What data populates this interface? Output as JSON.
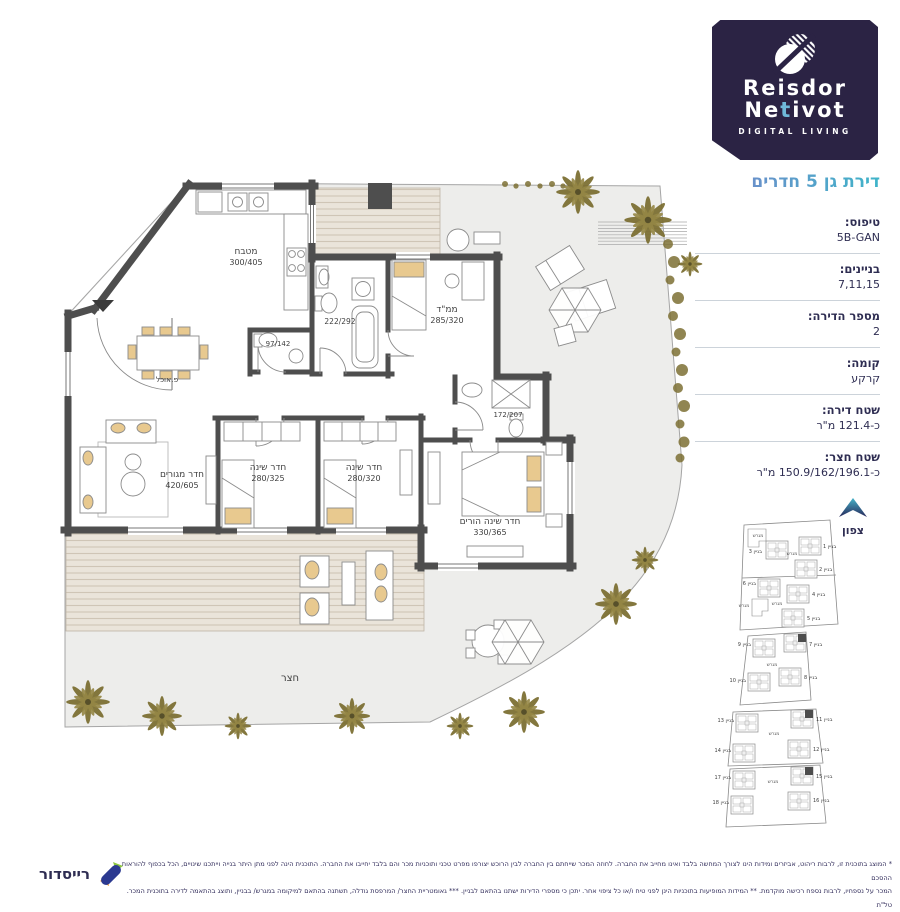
{
  "brand": {
    "name_line1": "Reisdor",
    "name_line2_pre": "Ne",
    "name_line2_accent": "t",
    "name_line2_post": "ivot",
    "tagline": "DIGITAL LIVING"
  },
  "header": {
    "title": "דירת גן 5 חדרים"
  },
  "details": {
    "rows": [
      {
        "label": "טיפוס:",
        "value": "5B-GAN"
      },
      {
        "label": "בניינים:",
        "value": "7,11,15"
      },
      {
        "label": "מספר הדירה:",
        "value": "2"
      },
      {
        "label": "קומה:",
        "value": "קרקע"
      },
      {
        "label": "שטח דירה:",
        "value": "כ-121.4 מ\"ר"
      },
      {
        "label": "שטח חצר:",
        "value": "כ-150.9/162/196.1 מ\"ר"
      }
    ]
  },
  "compass": {
    "label": "צפון"
  },
  "plan": {
    "kitchen": {
      "name": "מטבח",
      "dims": "300/405"
    },
    "mamad": {
      "name": "ממ\"ד",
      "dims": "285/320"
    },
    "bedroom1": {
      "name": "חדר שינה",
      "dims": "280/325"
    },
    "bedroom2": {
      "name": "חדר שינה",
      "dims": "280/320"
    },
    "master": {
      "name": "חדר שינה הורים",
      "dims": "330/365"
    },
    "living": {
      "name": "חדר מגורים",
      "dims": "420/605"
    },
    "dining": "פ.אוכל",
    "wc": "97/142",
    "bath": "222/292",
    "shower": "172/207",
    "yard": "חצר"
  },
  "siteplan": {
    "plot_label": "מגרש",
    "buildings": [
      {
        "label": "בניין 1",
        "highlighted": false
      },
      {
        "label": "בניין 2",
        "highlighted": false
      },
      {
        "label": "בניין 3",
        "highlighted": false
      },
      {
        "label": "בניין 4",
        "highlighted": false
      },
      {
        "label": "בניין 5",
        "highlighted": false
      },
      {
        "label": "בניין 6",
        "highlighted": false
      },
      {
        "label": "בניין 7",
        "highlighted": true
      },
      {
        "label": "בניין 8",
        "highlighted": false
      },
      {
        "label": "בניין 9",
        "highlighted": false
      },
      {
        "label": "בניין 10",
        "highlighted": false
      },
      {
        "label": "בניין 11",
        "highlighted": true
      },
      {
        "label": "בניין 12",
        "highlighted": false
      },
      {
        "label": "בניין 13",
        "highlighted": false
      },
      {
        "label": "בניין 14",
        "highlighted": false
      },
      {
        "label": "בניין 15",
        "highlighted": true
      },
      {
        "label": "בניין 16",
        "highlighted": false
      },
      {
        "label": "בניין 17",
        "highlighted": false
      },
      {
        "label": "בניין 18",
        "highlighted": false
      }
    ]
  },
  "footer": {
    "disclaimer_line1": "* המוצג בתוכנית זו, לרבות ריהוט, אביזרים ומידות הינו לצורך המחשה בלבד ואינו מחייב את החברה. לחוזה המכר שייחתם בין החברה לבין הרוכש יצורפו מפרט טכני ותוכניות מכר והם בלבד יחייבו את החברה. התוכנית הינה לפני מתן היתר בנייה וייתכנו שינויים, הכל בכפוף להוראות ההסכם",
    "disclaimer_line2": "המכר על נספחיו, לרבות נספח רכישה מוקדמת. ** המידות המופיעות בתוכניות הינן לפני טיח ו/או כל ציפוי אחר. יתכן כי מספרי הדירות ישתנו בהתאם לבניין. *** גאומטריית החצר/ המרפסת גודלה, תשתנה בהתאם למיקומה במגרש/ בבניין, ותוצג בהתאמה לדירה בתוכנית המכר. טל\"ת",
    "logo_text": "רייסדור"
  },
  "colors": {
    "brand_navy": "#2b2344",
    "accent_teal": "#3fb4c9",
    "accent_periwinkle": "#7b82cb",
    "wall": "#4e4e4e",
    "deck": "#eae4da",
    "yard": "#ededeb",
    "cushion": "#e8c98f",
    "palm": "#7d7034"
  }
}
